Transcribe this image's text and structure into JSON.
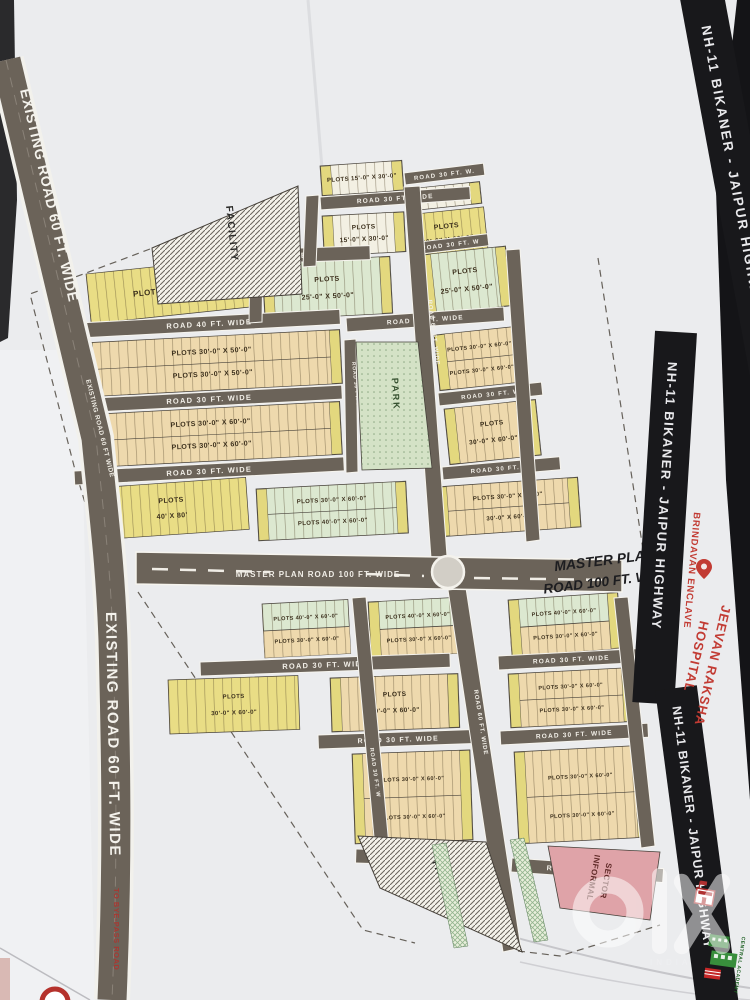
{
  "labels": {
    "highway": "NH-11 BIKANER - JAIPUR HIGHWAY",
    "project": "BRINDAVAN ENCLAVE",
    "hospital_1": "JEEVAN RAKSHA",
    "hospital_2": "HOSPITAL",
    "academy": "CENTRAL ACADEMY",
    "master_caption_1": "MASTER PLAN",
    "master_caption_2": "ROAD 100 FT. WIDE",
    "master_road": "MASTER PLAN ROAD 100 FT. WIDE",
    "existing_road_top": "EXISTING ROAD 60 FT. WIDE",
    "existing_road_small": "EXISTING ROAD 60 FT WIDE",
    "existing_road_bottom": "EXISTING ROAD 60 FT. WIDE",
    "to_bypass": "TO BYE-PASS ROAD",
    "park": "PARK",
    "facility_top": "FACILITY",
    "facility_bottom": "FACILITY",
    "informal_1": "INFORMAL",
    "informal_2": "SECTOR",
    "watermark_brand": "olx",
    "watermark_country": "INDIA"
  },
  "colors": {
    "paper": "#ebecee",
    "road": "#6b6359",
    "road_edge": "#f6f4ee",
    "yellow_plot": "#e9dd85",
    "tan_plot": "#eed9ad",
    "green_plot": "#dce8d0",
    "white_plot": "#f3f0e3",
    "park_green": "#d4e2c6",
    "informal_pink": "#dfa3a8",
    "band_black": "#18181b",
    "accent_red": "#c23b33",
    "academy_green": "#2e7d32"
  },
  "plan": {
    "roads": [
      {
        "x": 320,
        "y": 197,
        "w": 150,
        "h": 13,
        "a": -4,
        "label": "ROAD 30 FT. WIDE",
        "fs": 6.5
      },
      {
        "x": 404,
        "y": 173,
        "w": 80,
        "h": 12,
        "a": -7,
        "label": "ROAD 30 FT. W.",
        "fs": 6
      },
      {
        "x": 158,
        "y": 253,
        "w": 212,
        "h": 14,
        "a": -2,
        "label": "ROAD 30 FT. WIDE",
        "fs": 7.5
      },
      {
        "x": 412,
        "y": 243,
        "w": 76,
        "h": 12,
        "a": -7,
        "label": "ROAD 30 FT. W",
        "fs": 6
      },
      {
        "x": 78,
        "y": 323,
        "w": 262,
        "h": 15,
        "a": -3,
        "label": "ROAD 40 FT. WIDE",
        "fs": 7.5
      },
      {
        "x": 346,
        "y": 318,
        "w": 158,
        "h": 14,
        "a": -4,
        "label": "ROAD 40 FT. WIDE",
        "fs": 6.5
      },
      {
        "x": 76,
        "y": 399,
        "w": 266,
        "h": 14,
        "a": -3,
        "label": "ROAD 30 FT. WIDE",
        "fs": 7.5
      },
      {
        "x": 438,
        "y": 393,
        "w": 104,
        "h": 13,
        "a": -6,
        "label": "ROAD 30 FT. W",
        "fs": 6
      },
      {
        "x": 74,
        "y": 471,
        "w": 270,
        "h": 14,
        "a": -3,
        "label": "ROAD 30 FT. WIDE",
        "fs": 7.5
      },
      {
        "x": 442,
        "y": 467,
        "w": 118,
        "h": 13,
        "a": -5,
        "label": "ROAD 30 FT. W.",
        "fs": 6
      },
      {
        "x": 200,
        "y": 662,
        "w": 250,
        "h": 14,
        "a": -2,
        "label": "ROAD 30 FT. WIDE",
        "fs": 7.5
      },
      {
        "x": 498,
        "y": 656,
        "w": 146,
        "h": 14,
        "a": -3,
        "label": "ROAD 30 FT. WIDE",
        "fs": 6.5
      },
      {
        "x": 318,
        "y": 735,
        "w": 160,
        "h": 14,
        "a": -2,
        "label": "ROAD 30 FT. WIDE",
        "fs": 7
      },
      {
        "x": 500,
        "y": 731,
        "w": 148,
        "h": 14,
        "a": -3,
        "label": "ROAD 30 FT. WIDE",
        "fs": 6.5
      },
      {
        "x": 356,
        "y": 849,
        "w": 142,
        "h": 14,
        "a": 2,
        "label": "ROAD 30 FT. WIDE",
        "fs": 7
      },
      {
        "x": 512,
        "y": 858,
        "w": 152,
        "h": 14,
        "a": 4,
        "label": "ROAD 30 FT. WIDE",
        "fs": 7
      }
    ],
    "vroads": [
      {
        "pts": "306,196 319,195 316,266 303,267",
        "label": "",
        "lx": 0,
        "ly": 0,
        "la": 0,
        "fs": 0
      },
      {
        "pts": "250,258 263,257 262,322 249,323",
        "label": "",
        "lx": 0,
        "ly": 0,
        "la": 0,
        "fs": 0
      },
      {
        "pts": "404,187 420,186 447,556 431,558",
        "label": "ROAD 60 FT. WIDE",
        "lx": 428,
        "ly": 300,
        "la": -7,
        "fs": 6
      },
      {
        "pts": "344,340 356,339 358,472 346,473",
        "label": "ROAD 30 FT. WIDE",
        "lx": 352,
        "ly": 362,
        "la": -6,
        "fs": 5
      },
      {
        "pts": "506,250 520,249 540,540 526,542",
        "label": "",
        "lx": 0,
        "ly": 0,
        "la": 0,
        "fs": 0
      },
      {
        "pts": "448,590 466,588 521,948 503,952",
        "label": "ROAD 60 FT. WIDE",
        "lx": 474,
        "ly": 690,
        "la": -9,
        "fs": 6
      },
      {
        "pts": "352,598 366,597 389,846 375,848",
        "label": "ROAD 30 FT. W",
        "lx": 370,
        "ly": 748,
        "la": -8,
        "fs": 5.5
      },
      {
        "pts": "614,598 628,597 655,846 641,848",
        "label": "",
        "lx": 0,
        "ly": 0,
        "la": 0,
        "fs": 0
      }
    ],
    "blocks": [
      {
        "x": 320,
        "y": 166,
        "w": 82,
        "h": 30,
        "a": -4,
        "f": "white",
        "labels": [
          "PLOTS 15'-0\" X 30'-0\""
        ],
        "fs": 6,
        "caps": true
      },
      {
        "x": 322,
        "y": 216,
        "w": 82,
        "h": 40,
        "a": -3,
        "f": "white",
        "labels": [
          "PLOTS",
          "15'-0\" X 30'-0\""
        ],
        "fs": 6.5,
        "caps": true
      },
      {
        "x": 408,
        "y": 189,
        "w": 72,
        "h": 22,
        "a": -6,
        "f": "white",
        "labels": [
          "15'-0\" X 30'-0\""
        ],
        "fs": 5.5,
        "caps": true
      },
      {
        "x": 406,
        "y": 215,
        "w": 78,
        "h": 46,
        "a": -6,
        "f": "yellow",
        "labels": [
          "PLOTS",
          "30'-0\" X 60'-0\""
        ],
        "fs": 7,
        "caps": false
      },
      {
        "x": 86,
        "y": 274,
        "w": 170,
        "h": 50,
        "a": -6,
        "f": "yellow",
        "labels": [
          "PLOTS  30'-0\" WIDE"
        ],
        "fs": 8,
        "caps": false
      },
      {
        "x": 262,
        "y": 263,
        "w": 128,
        "h": 57,
        "a": -3,
        "f": "green",
        "labels": [
          "PLOTS",
          "25'-0\" X 50'-0\""
        ],
        "fs": 7,
        "caps": true
      },
      {
        "x": 420,
        "y": 255,
        "w": 86,
        "h": 60,
        "a": -6,
        "f": "green",
        "labels": [
          "PLOTS",
          "25'-0\" X 50'-0\""
        ],
        "fs": 7,
        "caps": true
      },
      {
        "x": 82,
        "y": 343,
        "w": 258,
        "h": 54,
        "a": -3,
        "f": "tan",
        "labels": [
          "PLOTS  30'-0\" X 50'-0\"",
          "PLOTS  30'-0\" X 50'-0\""
        ],
        "rows": 2,
        "fs": 7,
        "caps": true
      },
      {
        "x": 80,
        "y": 415,
        "w": 260,
        "h": 53,
        "a": -3,
        "f": "tan",
        "labels": [
          "PLOTS  30'-0\" X 60'-0\"",
          "PLOTS  30'-0\" X 60'-0\""
        ],
        "rows": 2,
        "fs": 7,
        "caps": true
      },
      {
        "x": 434,
        "y": 335,
        "w": 88,
        "h": 56,
        "a": -6,
        "f": "tan",
        "labels": [
          "PLOTS  30'-0\" X 60'-0\"",
          "PLOTS  30'-0\" X 60'-0\""
        ],
        "rows": 2,
        "fs": 5.5,
        "caps": true
      },
      {
        "x": 444,
        "y": 409,
        "w": 92,
        "h": 56,
        "a": -6,
        "f": "tan",
        "labels": [
          "PLOTS",
          "30'-0\" X 60'-0\""
        ],
        "fs": 6.5,
        "caps": true
      },
      {
        "x": 94,
        "y": 488,
        "w": 152,
        "h": 52,
        "a": -4,
        "f": "yellow",
        "labels": [
          "PLOTS",
          "40' X 80'"
        ],
        "fs": 7,
        "caps": false
      },
      {
        "x": 256,
        "y": 489,
        "w": 150,
        "h": 52,
        "a": -3,
        "f": "green",
        "labels": [
          "PLOTS  30'-0\" X 60'-0\"",
          "PLOTS  40'-0\" X 60'-0\""
        ],
        "rows": 2,
        "fs": 6,
        "caps": true
      },
      {
        "x": 436,
        "y": 487,
        "w": 142,
        "h": 50,
        "a": -4,
        "f": "tan",
        "labels": [
          "PLOTS  30'-0\" X 60'-0\"",
          "30'-0\" X 60'-0\""
        ],
        "rows": 2,
        "fs": 6,
        "caps": true
      },
      {
        "x": 262,
        "y": 604,
        "w": 86,
        "h": 54,
        "a": -3,
        "f": "green",
        "f2": "tan",
        "labels": [
          "PLOTS  40'-0\" X 60'-0\"",
          "PLOTS  30'-0\" X 60'-0\""
        ],
        "rows": 2,
        "fs": 5.5,
        "caps": false
      },
      {
        "x": 368,
        "y": 602,
        "w": 98,
        "h": 56,
        "a": -3,
        "f": "green",
        "f2": "tan",
        "labels": [
          "PLOTS  40'-0\" X 60'-0\"",
          "PLOTS  30'-0\" X 60'-0\""
        ],
        "rows": 2,
        "fs": 5.5,
        "caps": true
      },
      {
        "x": 508,
        "y": 600,
        "w": 110,
        "h": 56,
        "a": -4,
        "f": "green",
        "f2": "tan",
        "labels": [
          "PLOTS  40'-0\" X 60'-0\"",
          "PLOTS  30'-0\" X 60'-0\""
        ],
        "rows": 2,
        "fs": 5.5,
        "caps": true
      },
      {
        "x": 168,
        "y": 680,
        "w": 130,
        "h": 54,
        "a": -2,
        "f": "yellow",
        "labels": [
          "PLOTS",
          "30'-0\" X 60'-0\""
        ],
        "fs": 6,
        "caps": false
      },
      {
        "x": 330,
        "y": 678,
        "w": 128,
        "h": 54,
        "a": -2,
        "f": "tan",
        "labels": [
          "PLOTS",
          "30'-0\" X 60'-0\""
        ],
        "fs": 6.5,
        "caps": true
      },
      {
        "x": 508,
        "y": 674,
        "w": 124,
        "h": 54,
        "a": -3,
        "f": "tan",
        "labels": [
          "PLOTS  30'-0\" X 60'-0\"",
          "PLOTS  30'-0\" X 60'-0\""
        ],
        "rows": 2,
        "fs": 5.5,
        "caps": true
      },
      {
        "x": 352,
        "y": 754,
        "w": 118,
        "h": 90,
        "a": -2,
        "f": "tan",
        "labels": [
          "PLOTS  30'-0\" X 60'-0\"",
          "PLOTS  30'-0\" X 60'-0\""
        ],
        "rows": 2,
        "fs": 5.5,
        "caps": true
      },
      {
        "x": 514,
        "y": 752,
        "w": 130,
        "h": 92,
        "a": -3,
        "f": "tan",
        "labels": [
          "PLOTS  30'-0\" X 60'-0\"",
          "PLOTS  30'-0\" X 60'-0\""
        ],
        "rows": 2,
        "fs": 5.5,
        "caps": true
      }
    ]
  }
}
